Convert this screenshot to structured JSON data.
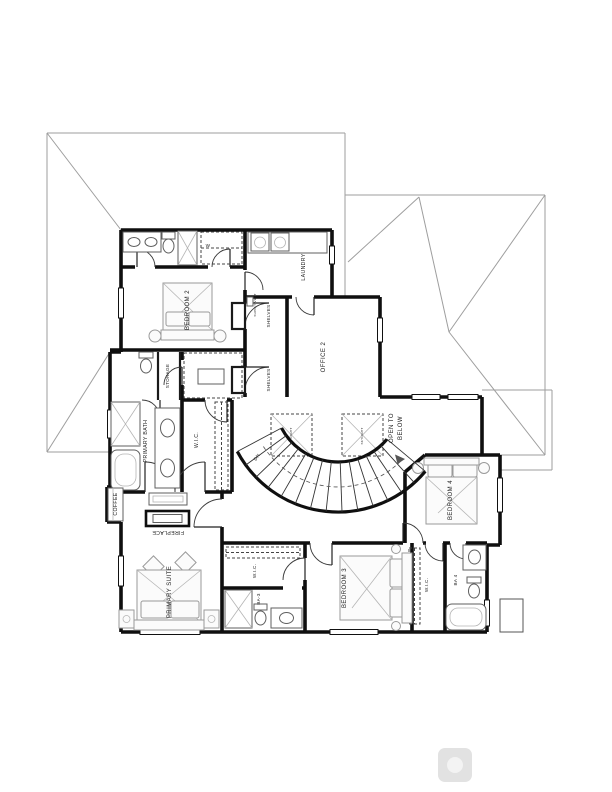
{
  "plan": {
    "labels": {
      "bedroom2": "BEDROOM 2",
      "wic2": "W",
      "laundry": "LAUNDRY",
      "office2": "OFFICE 2",
      "shelves_upper": "SHELVES",
      "shelves_lower": "SHELVES",
      "storage": "STORAGE",
      "primary_bath": "PRIMARY BATH",
      "primary_wic": "W.I.C.",
      "open_to_below_line1": "OPEN TO",
      "open_to_below_line2": "BELOW",
      "stairs_dn": "DN",
      "coffee": "COFFEE",
      "fireplace": "FIREPLACE",
      "primary_suite": "PRIMARY SUITE",
      "wic_bedroom3": "W.I.C.",
      "bath3": "BA-3",
      "bedroom3": "BEDROOM 3",
      "wic_bedroom4": "W.I.C.",
      "bath4": "BA 4",
      "bedroom4": "BEDROOM 4",
      "skylight_note_1": "SKYLIGHT",
      "skylight_note_2": "SKYLIGHT",
      "supply_note": "SUPPLY VENT"
    },
    "colors": {
      "wall": "#0f0f0f",
      "roof_line": "#9e9e9e",
      "fixture": "#5f5f5f",
      "furniture": "#9a9a9a",
      "paper": "#ffffff"
    }
  }
}
